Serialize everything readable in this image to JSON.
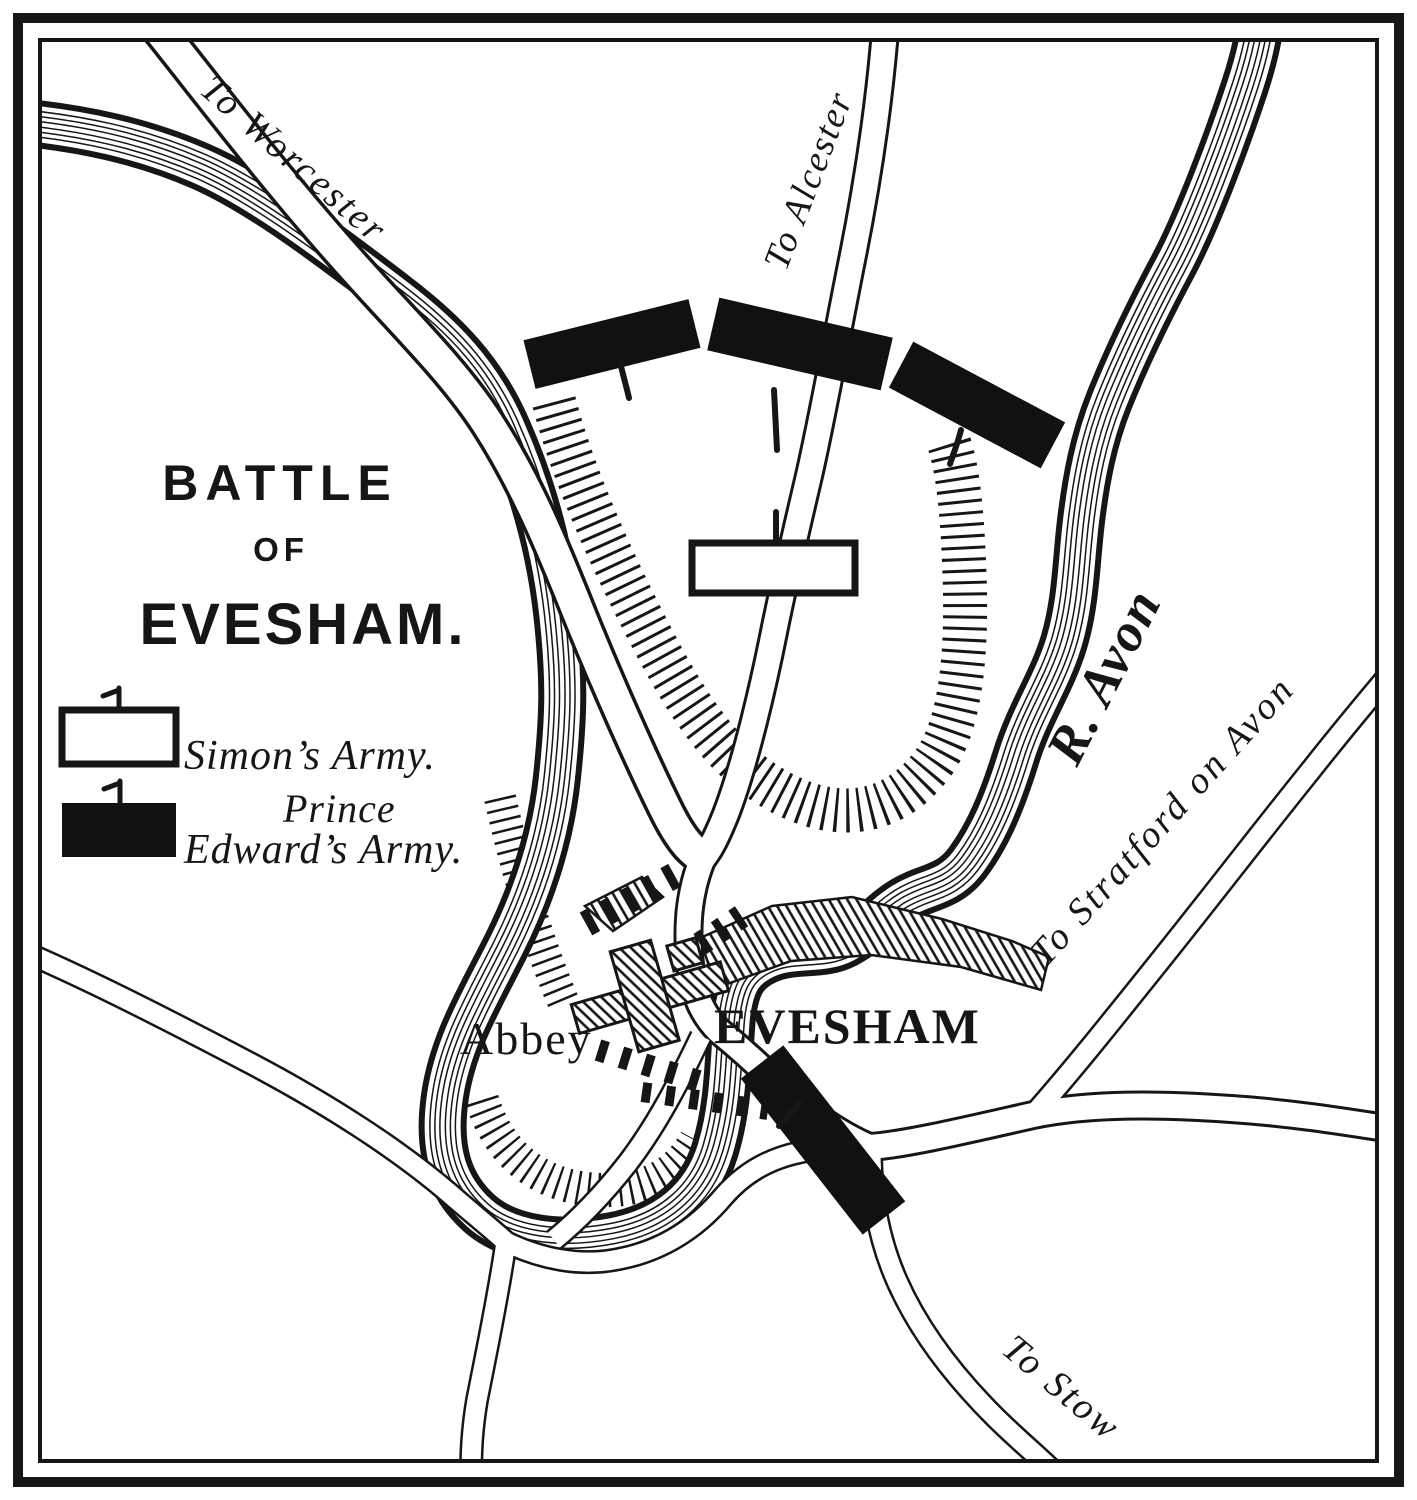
{
  "map": {
    "title": {
      "line1": "BATTLE",
      "line2": "OF",
      "line3": "EVESHAM."
    },
    "legend": {
      "simon_label": "Simon’s Army.",
      "edward_label_line1": "Prince",
      "edward_label_line2": "Edward’s Army."
    },
    "places": {
      "abbey": "Abbey",
      "town": "EVESHAM",
      "river": "R. Avon"
    },
    "roads": {
      "worcester": "To Worcester",
      "alcester": "To Alcester",
      "stratford": "To Stratford on Avon",
      "stow": "To Stow"
    },
    "colors": {
      "ink": "#161616",
      "paper": "#ffffff",
      "edward": "#111111",
      "simon": "#ffffff"
    }
  }
}
